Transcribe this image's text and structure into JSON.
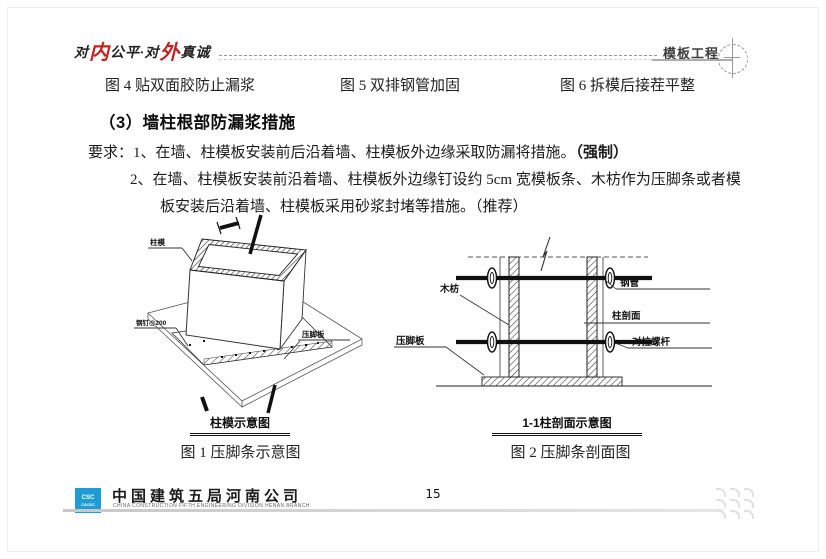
{
  "header": {
    "slogan_parts": {
      "p1": "对",
      "r1": "内",
      "p2": "公平·对",
      "r2": "外",
      "p3": "真诚"
    },
    "section_label": "模板工程"
  },
  "captions_top": {
    "fig4": "图 4 贴双面胶防止漏浆",
    "fig5": "图 5 双排钢管加固",
    "fig6": "图 6 拆模后接茬平整"
  },
  "section": {
    "heading": "（3）墙柱根部防漏浆措施",
    "req_line1": "要求：1、在墙、柱模板安装前后沿着墙、柱模板外边缘采取防漏将措施。",
    "req_line1_bold": "（强制）",
    "req_line2": "2、在墙、柱模板安装前沿着墙、柱模板外边缘钉设约 5cm 宽模板条、木枋作为压脚条或者模",
    "req_line3": "板安装后沿着墙、柱模板采用砂浆封堵等措施。（推荐）"
  },
  "figure1": {
    "labels": {
      "zhumo": "柱模",
      "gangding": "钢钉@200",
      "yajiaoban": "压脚板"
    },
    "title": "柱模示意图",
    "caption": "图 1 压脚条示意图"
  },
  "figure2": {
    "labels": {
      "mufang": "木枋",
      "yajiaoban": "压脚板",
      "gangguan": "钢管",
      "zhupoumian": "柱剖面",
      "duilaluogan": "对拉螺杆"
    },
    "title": "1-1柱剖面示意图",
    "caption": "图 2 压脚条剖面图"
  },
  "footer": {
    "logo_top": "CSC",
    "logo_abbr": "CSCEC",
    "company": "中国建筑五局河南公司",
    "company_en": "CHINA CONSTRUCTION FIFTH ENGINEERING DIVISION HENAN BRANCH",
    "page_number": "15"
  },
  "colors": {
    "accent_red": "#c32222",
    "logo_blue": "#1f9bd7",
    "footer_line": "#d9d9d9"
  }
}
